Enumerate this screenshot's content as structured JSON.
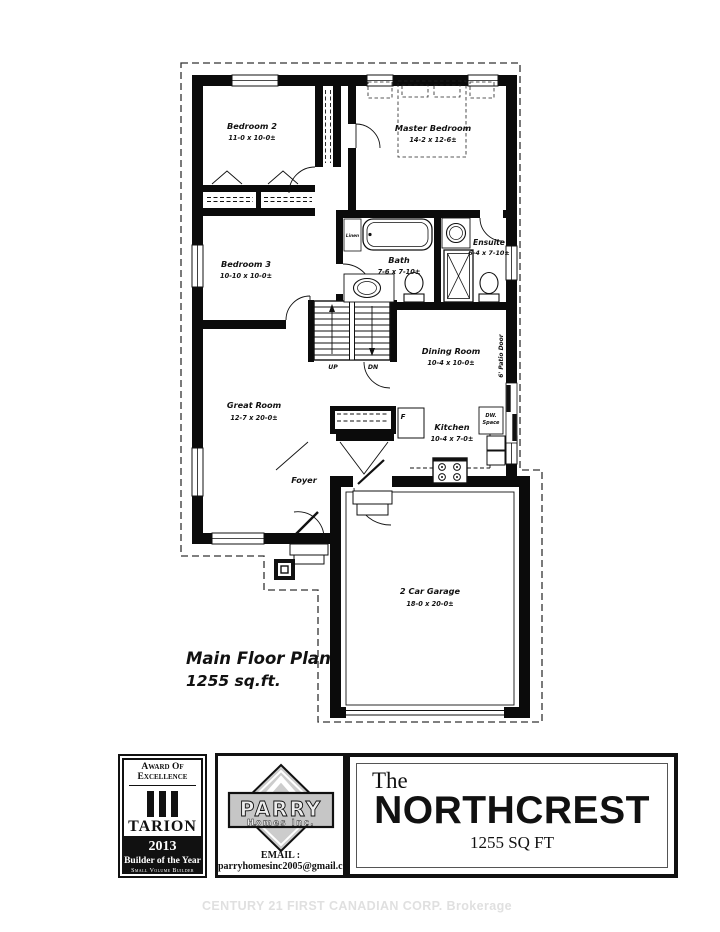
{
  "watermark": "CENTURY 21 FIRST CANADIAN CORP. Brokerage",
  "plan": {
    "title": "Main Floor Plan",
    "sqft": "1255 sq.ft.",
    "rooms": {
      "bedroom2": {
        "name": "Bedroom 2",
        "dims": "11-0 x 10-0±"
      },
      "master": {
        "name": "Master Bedroom",
        "dims": "14-2 x 12-6±"
      },
      "bedroom3": {
        "name": "Bedroom 3",
        "dims": "10-10 x 10-0±"
      },
      "bath": {
        "name": "Bath",
        "dims": "7-6 x 7-10±"
      },
      "ensuite": {
        "name": "Ensuite",
        "dims": "6-4 x 7-10±"
      },
      "dining": {
        "name": "Dining Room",
        "dims": "10-4 x 10-0±"
      },
      "great": {
        "name": "Great Room",
        "dims": "12-7 x 20-0±"
      },
      "kitchen": {
        "name": "Kitchen",
        "dims": "10-4 x 7-0±"
      },
      "garage": {
        "name": "2 Car Garage",
        "dims": "18-0 x 20-0±"
      },
      "foyer": {
        "name": "Foyer"
      }
    },
    "annotations": {
      "linen": "Linen",
      "patio_door": "6' Patio Door",
      "dw_line1": "DW.",
      "dw_line2": "Space",
      "fridge": "F",
      "up": "UP",
      "dn": "DN"
    }
  },
  "tarion": {
    "award_line1": "Award Of",
    "award_line2": "Excellence",
    "name": "TARION",
    "year": "2013",
    "title": "Builder of the Year",
    "subtitle": "Small Volume Builder"
  },
  "parry": {
    "brand": "PARRY",
    "sub": "Homes Inc.",
    "email": "EMAIL : parryhomesinc2005@gmail.com"
  },
  "titleblock": {
    "prefix": "The",
    "name": "NORTHCREST",
    "sqft": "1255 SQ FT"
  }
}
